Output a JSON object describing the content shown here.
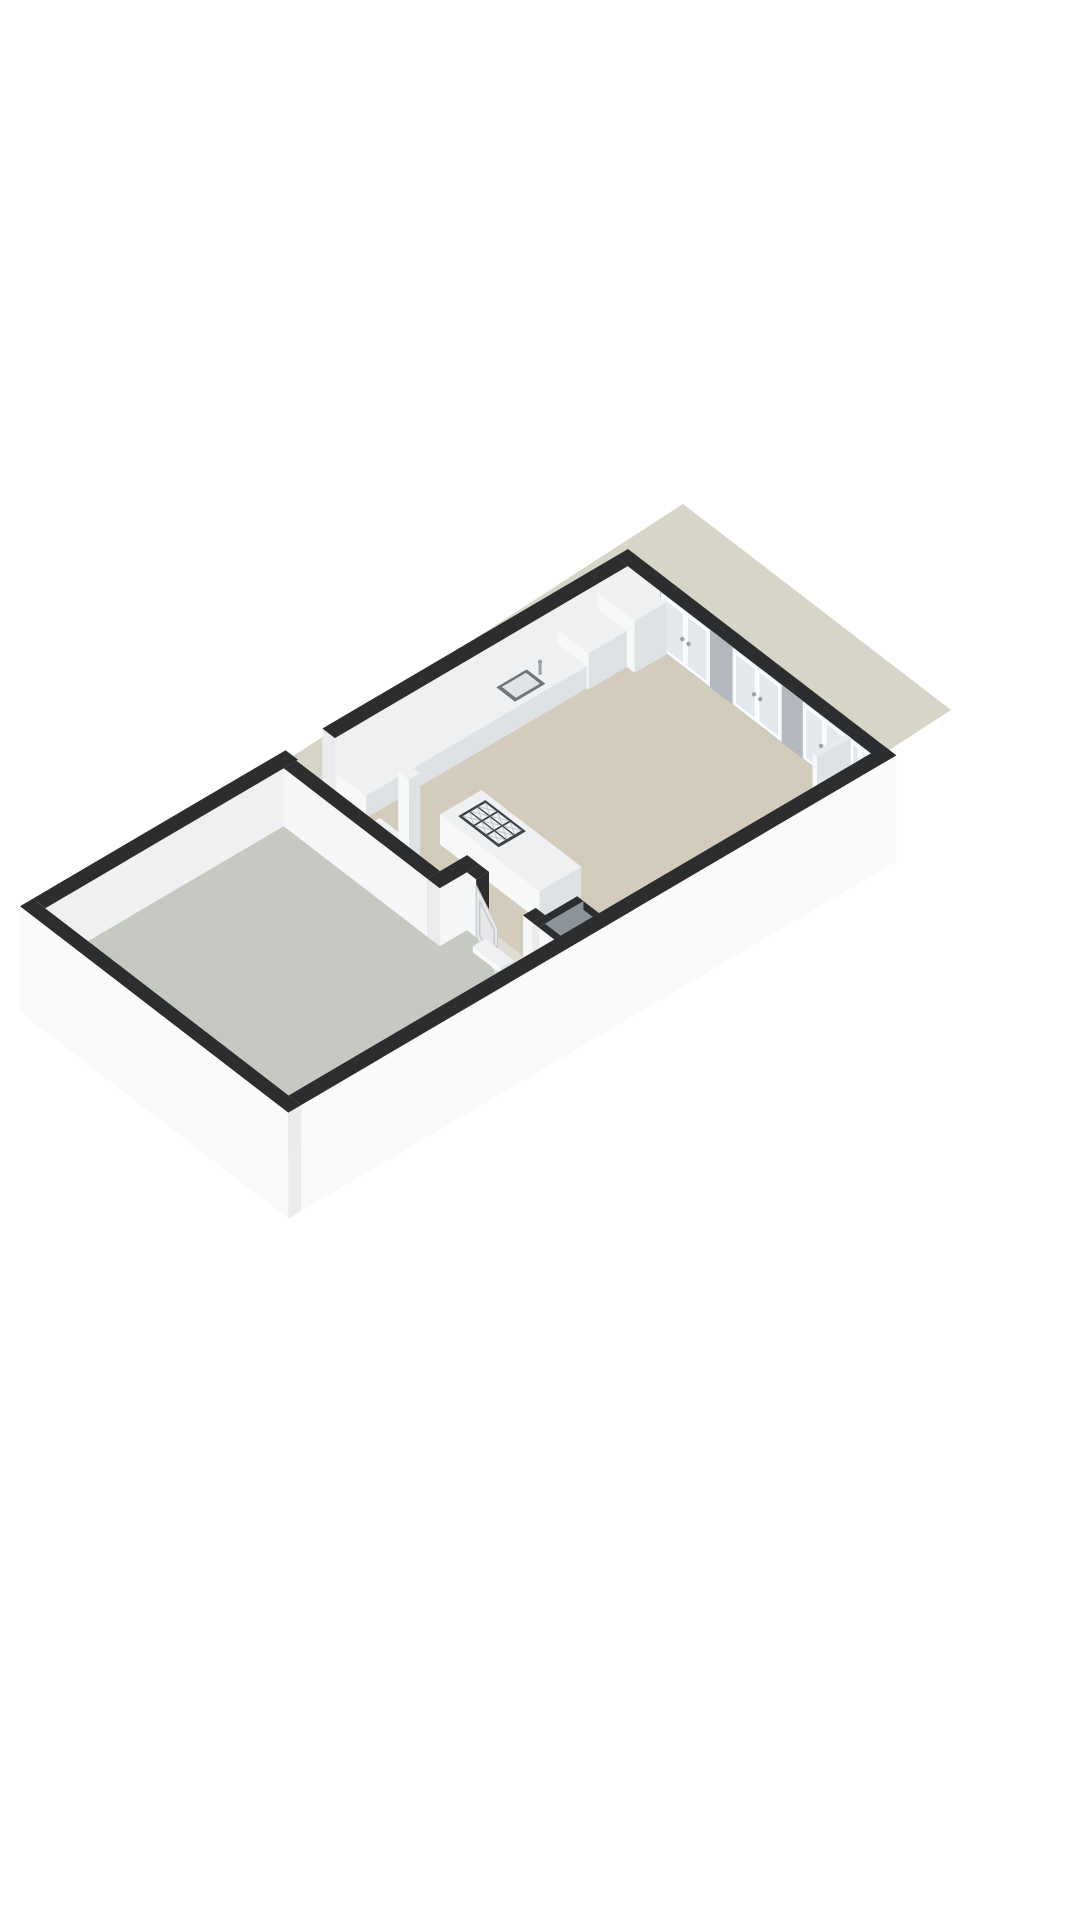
{
  "meta": {
    "title": "3D floor plan rendering",
    "style": "isometric dollhouse cutaway, walls cut at fixed height with dark tops",
    "background": "#ffffff",
    "rooms": [
      {
        "name": "living-kitchen",
        "floor": "beige"
      },
      {
        "name": "terrace",
        "floor": "gray-green"
      },
      {
        "name": "shaft",
        "floor": "shadowed"
      }
    ],
    "features": [
      "4 glazed french-door window sets on upper-right wall",
      "kitchen counter with sink and faucet along upper-left wall",
      "tall cabinet at top corner",
      "kitchen island with 9-burner cooktop",
      "free-standing flue pillar and low cabinet",
      "open interior panel door with dark frame",
      "small service shaft with dark-topped walls",
      "doorway opening in upper-left outer wall",
      "flat ground shadow behind the volume"
    ]
  },
  "colors": {
    "background": "#ffffff",
    "shadow": "#d7d4c8",
    "floor_beige": "#d3cbbc",
    "floor_terrace": "#c5c9c2",
    "threshold": "#e0ddd5",
    "band_black": "#2b2d2f",
    "wall_inner_white": "#f1f2f3",
    "wall_inner_white2": "#eef0f1",
    "wall_inner_gray": "#b3b9bf",
    "wall_face_white": "#f5f6f7",
    "wall_end_white": "#e9ebec",
    "wall_outer_white": "#f9fafa",
    "glass": "#e4e9ed",
    "frame_white": "#f6f8f9",
    "frame_dark": "#2b2d2f",
    "steel": "#9aa1a6",
    "box_top": "#eff0f1",
    "box_side_e": "#dfe2e4",
    "box_side_s": "#f7f8f8",
    "stub_top": "#e9ebec",
    "cooktop_plate": "#3e4245",
    "burner_cell": "#f0f2f3",
    "burner_line": "#c3c7ca",
    "sink_ring": "#70757a",
    "sink_inner": "#e1e4e6",
    "door_leaf": "#e7e8e9",
    "leaf_panel": "#c7cacc",
    "shaft_inner": "#8d9499",
    "shaft_floor": "#b0aa9e"
  },
  "projection": {
    "origin": [
      628,
      607
    ],
    "a": [
      0.78,
      0.6
    ],
    "b": [
      -0.8,
      0.47
    ],
    "wall_height": 58,
    "wall_thickness": 16,
    "skirt": 48
  },
  "scene": {
    "elements": [
      {
        "name": "ground-shadow",
        "type": "shadow",
        "color": "shadow",
        "points": [
          [
            683,
            504
          ],
          [
            951,
            710
          ],
          [
            363,
            1090
          ],
          [
            95,
            884
          ]
        ]
      },
      {
        "name": "ne-wall-segment-1",
        "type": "faceY",
        "color": "wall_inner_white",
        "y": 16,
        "x0": 16,
        "x1": 58,
        "z0": 0,
        "z1": 58
      },
      {
        "name": "french-door-1",
        "type": "frenchdoor",
        "y": 16,
        "x0": 58,
        "x1": 122
      },
      {
        "name": "ne-wall-segment-2",
        "type": "faceY",
        "color": "wall_inner_gray",
        "y": 16,
        "x0": 122,
        "x1": 150,
        "z0": 0,
        "z1": 58
      },
      {
        "name": "french-door-2",
        "type": "frenchdoor",
        "y": 16,
        "x0": 150,
        "x1": 214
      },
      {
        "name": "ne-wall-segment-3",
        "type": "faceY",
        "color": "wall_inner_gray",
        "y": 16,
        "x0": 214,
        "x1": 240,
        "z0": 0,
        "z1": 58
      },
      {
        "name": "french-door-3",
        "type": "frenchdoor",
        "y": 16,
        "x0": 240,
        "x1": 296
      },
      {
        "name": "ne-wall-segment-4",
        "type": "faceY",
        "color": "wall_inner_white",
        "y": 16,
        "x0": 296,
        "x1": 300,
        "z0": 0,
        "z1": 58
      },
      {
        "name": "french-door-4",
        "type": "frenchdoor",
        "y": 16,
        "x0": 300,
        "x1": 328
      },
      {
        "name": "ne-wall-top-band",
        "type": "band",
        "color": "band_black",
        "x0": 0,
        "y0": 0,
        "x1": 344,
        "y1": 16,
        "z": 58
      },
      {
        "name": "nw-wall-upper",
        "type": "faceX",
        "color": "wall_inner_white2",
        "x": 16,
        "y0": 16,
        "y1": 382,
        "z0": 0,
        "z1": 58
      },
      {
        "name": "nw-doorway-jamb",
        "type": "faceY",
        "color": "wall_end_white",
        "y": 382,
        "x0": 0,
        "x1": 16,
        "z0": 0,
        "z1": 58
      },
      {
        "name": "nw-wall-upper-top-band",
        "type": "band",
        "color": "band_black",
        "x0": 0,
        "y0": 16,
        "x1": 16,
        "y1": 382,
        "z": 58
      },
      {
        "name": "nw-wall-lower",
        "type": "faceX",
        "color": "wall_inner_white2",
        "x": 16,
        "y0": 428,
        "y1": 744,
        "z0": 0,
        "z1": 58
      },
      {
        "name": "nw-wall-lower-top-band",
        "type": "band",
        "color": "band_black",
        "x0": 0,
        "y0": 428,
        "x1": 16,
        "y1": 744,
        "z": 58
      },
      {
        "name": "living-kitchen-floor",
        "type": "floor",
        "color": "floor_beige",
        "poly": [
          [
            16,
            16
          ],
          [
            328,
            16
          ],
          [
            328,
            396
          ],
          [
            216,
            396
          ],
          [
            216,
            430
          ],
          [
            16,
            430
          ]
        ]
      },
      {
        "name": "terrace-floor",
        "type": "floor",
        "color": "floor_terrace",
        "poly": [
          [
            16,
            446
          ],
          [
            216,
            446
          ],
          [
            216,
            412
          ],
          [
            328,
            412
          ],
          [
            328,
            744
          ],
          [
            16,
            744
          ]
        ]
      },
      {
        "name": "doorway-threshold",
        "type": "floor",
        "color": "threshold",
        "poly": [
          [
            228,
            396
          ],
          [
            288,
            396
          ],
          [
            288,
            412
          ],
          [
            228,
            412
          ]
        ]
      },
      {
        "name": "window-pier-stub",
        "type": "box",
        "x0": 296,
        "y0": 16,
        "x1": 302,
        "y1": 58,
        "h": 58,
        "top": "stub_top",
        "px": "box_side_e",
        "py": "box_side_s"
      },
      {
        "name": "kitchen-tall-cabinet",
        "type": "box",
        "x0": 18,
        "y0": 16,
        "x1": 66,
        "y1": 56,
        "h": 52,
        "top": "box_top",
        "px": "box_side_e",
        "py": "box_side_s"
      },
      {
        "name": "kitchen-mid-cabinet",
        "type": "box",
        "x0": 16,
        "y0": 56,
        "x1": 56,
        "y1": 104,
        "h": 36,
        "top": "box_top",
        "px": "box_side_e",
        "py": "box_side_s"
      },
      {
        "name": "kitchen-counter",
        "type": "box",
        "x0": 16,
        "y0": 104,
        "x1": 54,
        "y1": 380,
        "h": 22,
        "top": "box_top",
        "px": "box_side_e",
        "py": "box_side_s"
      },
      {
        "name": "kitchen-sink",
        "type": "sink",
        "x0": 24,
        "y0": 150,
        "x1": 48,
        "y1": 188,
        "z": 22
      },
      {
        "name": "kitchen-low-cabinet",
        "type": "box",
        "x0": 86,
        "y0": 394,
        "x1": 126,
        "y1": 424,
        "h": 26,
        "top": "box_top",
        "px": "box_side_e",
        "py": "box_side_s"
      },
      {
        "name": "flue-pillar",
        "type": "box",
        "x0": 130,
        "y0": 400,
        "x1": 144,
        "y1": 414,
        "h": 108,
        "top": "box_top",
        "px": "box_side_e",
        "py": "box_side_s"
      },
      {
        "name": "kitchen-island",
        "type": "box",
        "x0": 120,
        "y0": 300,
        "x1": 248,
        "y1": 352,
        "h": 30,
        "top": "box_top",
        "px": "box_side_e",
        "py": "box_side_s"
      },
      {
        "name": "cooktop",
        "type": "cooktop",
        "x0": 132,
        "y0": 307,
        "x1": 184,
        "y1": 341,
        "z": 30,
        "cols": 3,
        "rows": 3
      },
      {
        "name": "partition-wall",
        "type": "box",
        "x0": 16,
        "y0": 430,
        "x1": 200,
        "y1": 446,
        "h": 58,
        "top": "band_black",
        "px": "wall_end_white",
        "py": "wall_face_white"
      },
      {
        "name": "connector-wall",
        "type": "box",
        "x0": 200,
        "y0": 396,
        "x1": 216,
        "y1": 446,
        "h": 58,
        "top": "band_black",
        "px": "wall_face_white",
        "py": "wall_end_white"
      },
      {
        "name": "door-jamb-left",
        "type": "box",
        "x0": 216,
        "y0": 396,
        "x1": 228,
        "y1": 412,
        "h": 58,
        "top": "band_black",
        "px": "frame_dark",
        "py": "wall_face_white"
      },
      {
        "name": "door-jamb-right",
        "type": "box",
        "x0": 288,
        "y0": 396,
        "x1": 300,
        "y1": 412,
        "h": 58,
        "top": "band_black",
        "px": "wall_end_white",
        "py": "wall_face_white"
      },
      {
        "name": "interior-door-leaf",
        "type": "doorleaf",
        "hinge": [
          228,
          412
        ],
        "free": [
          280,
          436
        ],
        "z0": 1,
        "z1": 52
      },
      {
        "name": "terrace-step",
        "type": "box",
        "x0": 240,
        "y0": 412,
        "x1": 276,
        "y1": 428,
        "h": 6,
        "top": "box_top",
        "px": "box_side_e",
        "py": "box_side_s"
      },
      {
        "name": "shaft-north-wall",
        "type": "box",
        "x0": 308,
        "y0": 356,
        "x1": 328,
        "y1": 364,
        "h": 58,
        "top": "band_black",
        "px": "shaft_inner",
        "py": "shaft_inner"
      },
      {
        "name": "shaft-floor",
        "type": "floor",
        "color": "shaft_floor",
        "poly": [
          [
            308,
            364
          ],
          [
            328,
            364
          ],
          [
            328,
            404
          ],
          [
            308,
            404
          ]
        ]
      },
      {
        "name": "shaft-west-wall",
        "type": "box",
        "x0": 300,
        "y0": 356,
        "x1": 308,
        "y1": 412,
        "h": 58,
        "top": "band_black",
        "px": "shaft_inner",
        "py": "wall_end_white"
      },
      {
        "name": "shaft-south-wall",
        "type": "box",
        "x0": 308,
        "y0": 404,
        "x1": 328,
        "y1": 412,
        "h": 58,
        "top": "band_black",
        "px": "shaft_inner",
        "py": "wall_face_white"
      },
      {
        "name": "se-outer-wall",
        "type": "box",
        "x0": 328,
        "y0": 0,
        "x1": 344,
        "y1": 744,
        "h": 58,
        "z0": -48,
        "top": "band_black",
        "px": "wall_outer_white",
        "py": "wall_end_white"
      },
      {
        "name": "sw-outer-wall",
        "type": "box",
        "x0": 0,
        "y0": 744,
        "x1": 344,
        "y1": 760,
        "h": 58,
        "z0": -48,
        "top": "band_black",
        "px": "wall_end_white",
        "py": "wall_outer_white"
      }
    ]
  }
}
